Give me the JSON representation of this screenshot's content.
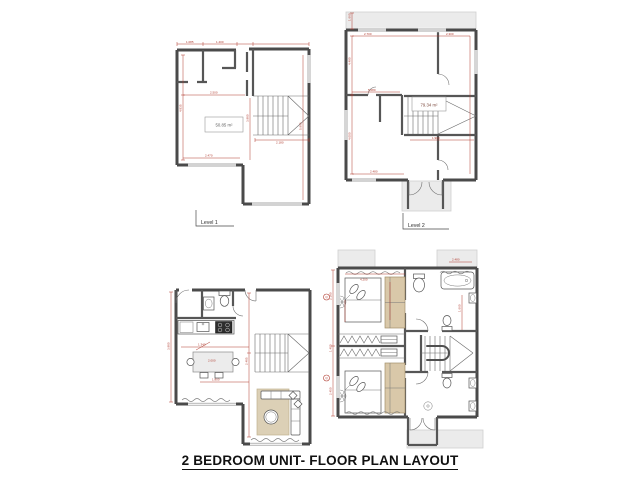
{
  "title": "2 BEDROOM UNIT- FLOOR PLAN LAYOUT",
  "colors": {
    "wall_gray": "#4a4a4a",
    "dimension_red": "#b03a2e",
    "furniture_beige": "#d9c8a9",
    "slab_gray": "#ebebeb"
  },
  "plans": {
    "level1_dim": {
      "level_label": "Level 1",
      "area_label": "50.85 m²",
      "dims": {
        "d0": "1.085",
        "d1": "1.400",
        "d2": "2.500",
        "d3": "4.835",
        "d4": "2.470",
        "d5": "5.965",
        "d6": "2.180",
        "d7": "3.980"
      }
    },
    "level2_dim": {
      "level_label": "Level 2",
      "area_label": "79.34 m²",
      "dims": {
        "d0": "2.700",
        "d1": "2.300",
        "d2": "4.490",
        "d3": "4.000",
        "d4": "5.080",
        "d5": "2.480",
        "d6": "1.900",
        "d7": "1.660"
      }
    },
    "level1_furnished": {
      "dims": {
        "d0": "2.000",
        "d1": "1.340",
        "d2": "2.485",
        "d3": "3.980",
        "d4": "1.800"
      }
    },
    "level2_furnished": {
      "dims": {
        "d0": "4.200",
        "d1": "2.180",
        "d2": "1.400",
        "d3": "2.450",
        "d4": "2.480",
        "d5": "1.660"
      }
    }
  },
  "grid_markers": {
    "top": "Q",
    "bottom": "Q"
  }
}
